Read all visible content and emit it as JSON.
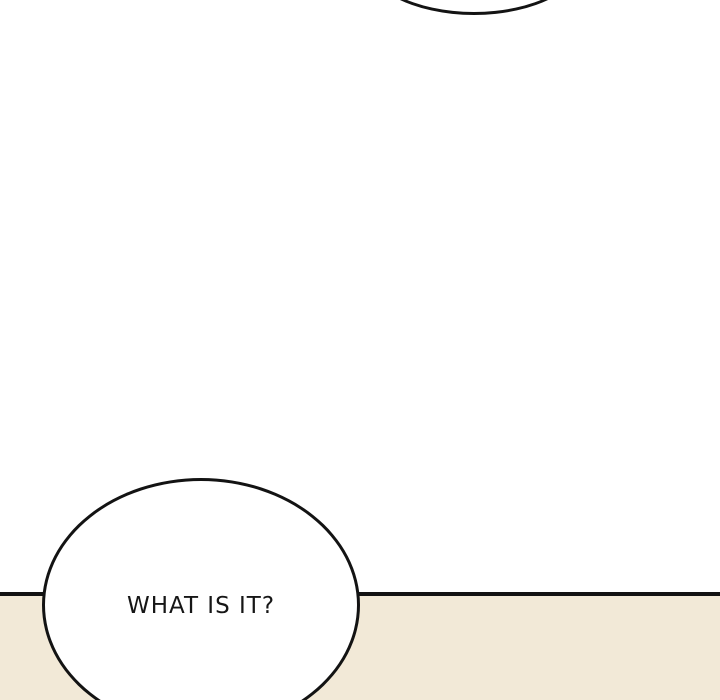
{
  "panel": {
    "type": "comic-panel",
    "background_color": "#ffffff",
    "floor_color": "#f2e9d7",
    "outline_color": "#131313"
  },
  "bubbles": {
    "top_partial": {
      "text": ""
    },
    "bottom": {
      "text": "WHAT IS IT?"
    }
  }
}
